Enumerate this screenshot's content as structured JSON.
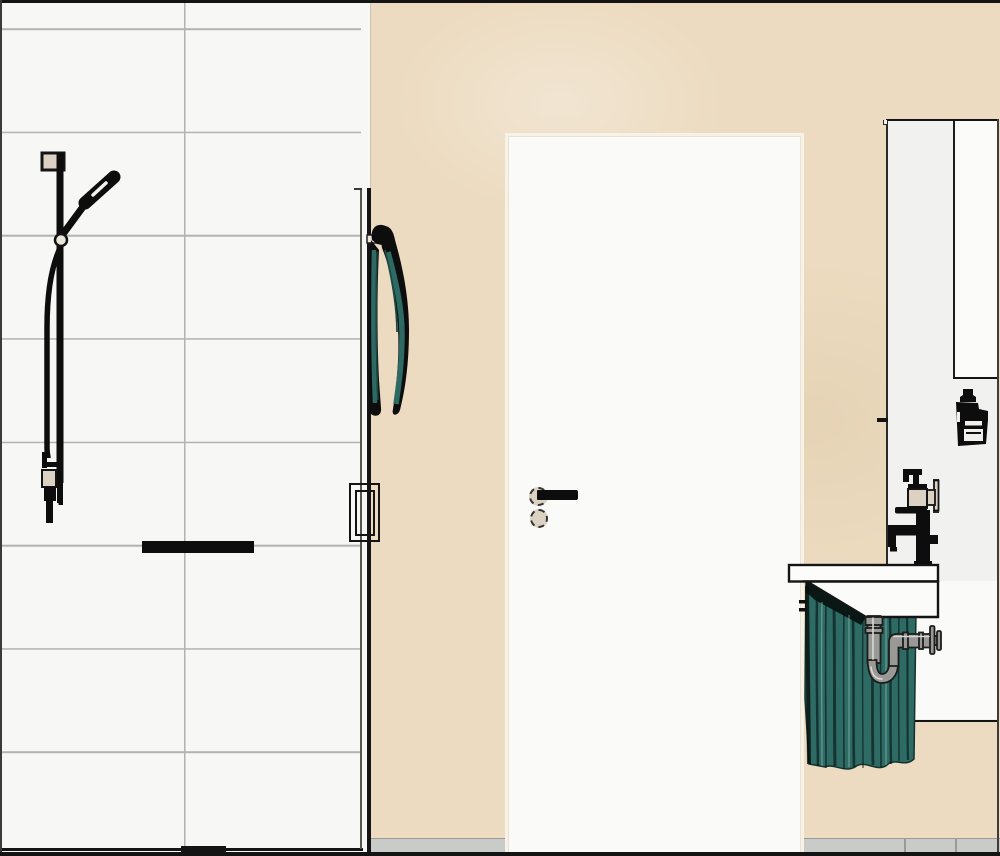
{
  "colors": {
    "outline": "#141414",
    "tile": "#f7f7f6",
    "grout": "#b2b2b0",
    "wall": "#ecdbc0",
    "door": "#fafaf9",
    "door_casing": "#f7f2e8",
    "panel": "#f1f1ef",
    "cabinet": "#fbfbfa",
    "niche": "#fafaf9",
    "fixture_black": "#0d0d0d",
    "hardware_beige": "#dbd2c3",
    "towel": "#2e6a64",
    "curtain": "#2f6b65",
    "curtain_dark": "#1c4742",
    "pipe": "#999997",
    "pipe_light": "#d8d8d6",
    "floor": "#c9cbc8",
    "floor_joint": "#9a9a98"
  },
  "fixtures": {
    "tile_wall": "Tiled shower wall",
    "shower_set": "Shower rail with hand shower and hose",
    "shower_bracket": "Shower rail wall bracket",
    "shower_outlet": "Shower wall outlet fitting",
    "shower_shelf": "Shower shelf bar",
    "glass_partition": "Glass shower partition",
    "shower_door_handle": "Shower door pull handle",
    "towel_hook": "Towel hook",
    "towel": "Hanging towel",
    "wall": "Painted wall",
    "entry_door": "Interior door",
    "door_lever": "Door lever handle",
    "door_lock": "Privacy lock rosette",
    "mirror_cabinet": "Mirror cabinet",
    "cabinet_door": "Tall cabinet door",
    "cosmetic_bottle": "Cosmetic bottle",
    "soap_dispenser": "Wall-mounted soap dispenser",
    "dispenser_bracket": "Dispenser wall bracket",
    "basin_faucet": "Black basin mixer tap",
    "washbasin": "Wall-hung washbasin",
    "sink_curtain": "Under-sink curtain",
    "sink_trap": "Chrome P-trap siphon",
    "trap_flange": "Wall connection flange",
    "floor": "Tiled floor strip",
    "drain": "Shower drain bar"
  }
}
